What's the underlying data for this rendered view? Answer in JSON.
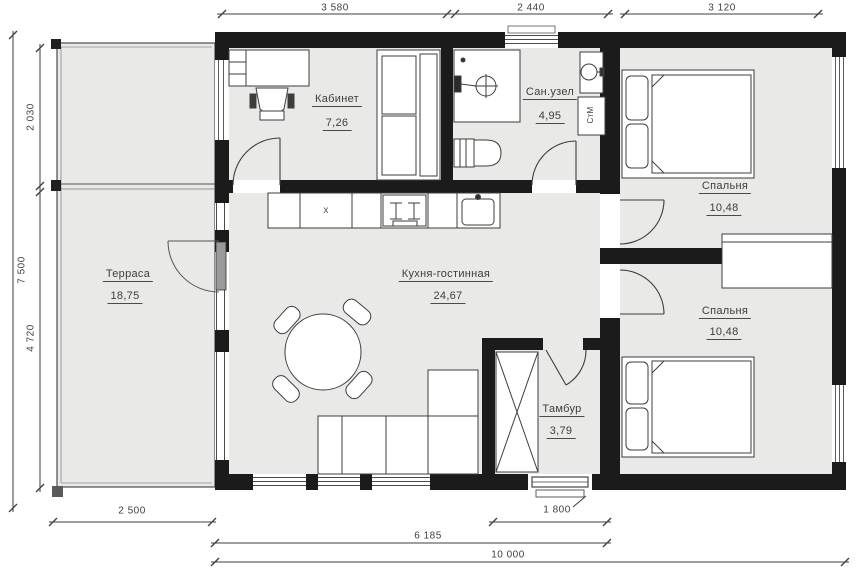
{
  "rooms": {
    "office": {
      "name": "Кабинет",
      "area": "7,26"
    },
    "bathroom": {
      "name": "Сан.узел",
      "area": "4,95"
    },
    "bedroom_top": {
      "name": "Спальня",
      "area": "10,48"
    },
    "bedroom_bottom": {
      "name": "Спальня",
      "area": "10,48"
    },
    "terrace": {
      "name": "Терраса",
      "area": "18,75"
    },
    "kitchen_living": {
      "name": "Кухня-гостинная",
      "area": "24,67"
    },
    "vestibule": {
      "name": "Тамбур",
      "area": "3,79"
    }
  },
  "appliances": {
    "washing_machine": "СтМ",
    "fridge_mark": "x"
  },
  "dimensions": {
    "top": [
      "3 580",
      "2 440",
      "3 120"
    ],
    "left_total": "7 500",
    "left_segments": [
      "2 030",
      "4 720"
    ],
    "bottom_terrace": "2 500",
    "bottom_entrance": "1 800",
    "bottom_main": "6 185",
    "bottom_total": "10 000"
  },
  "colors": {
    "wall": "#1b1b1b",
    "floor": "#e9e9e7",
    "line": "#3f3f3f",
    "text": "#3d3d3d",
    "paper": "#ffffff"
  }
}
